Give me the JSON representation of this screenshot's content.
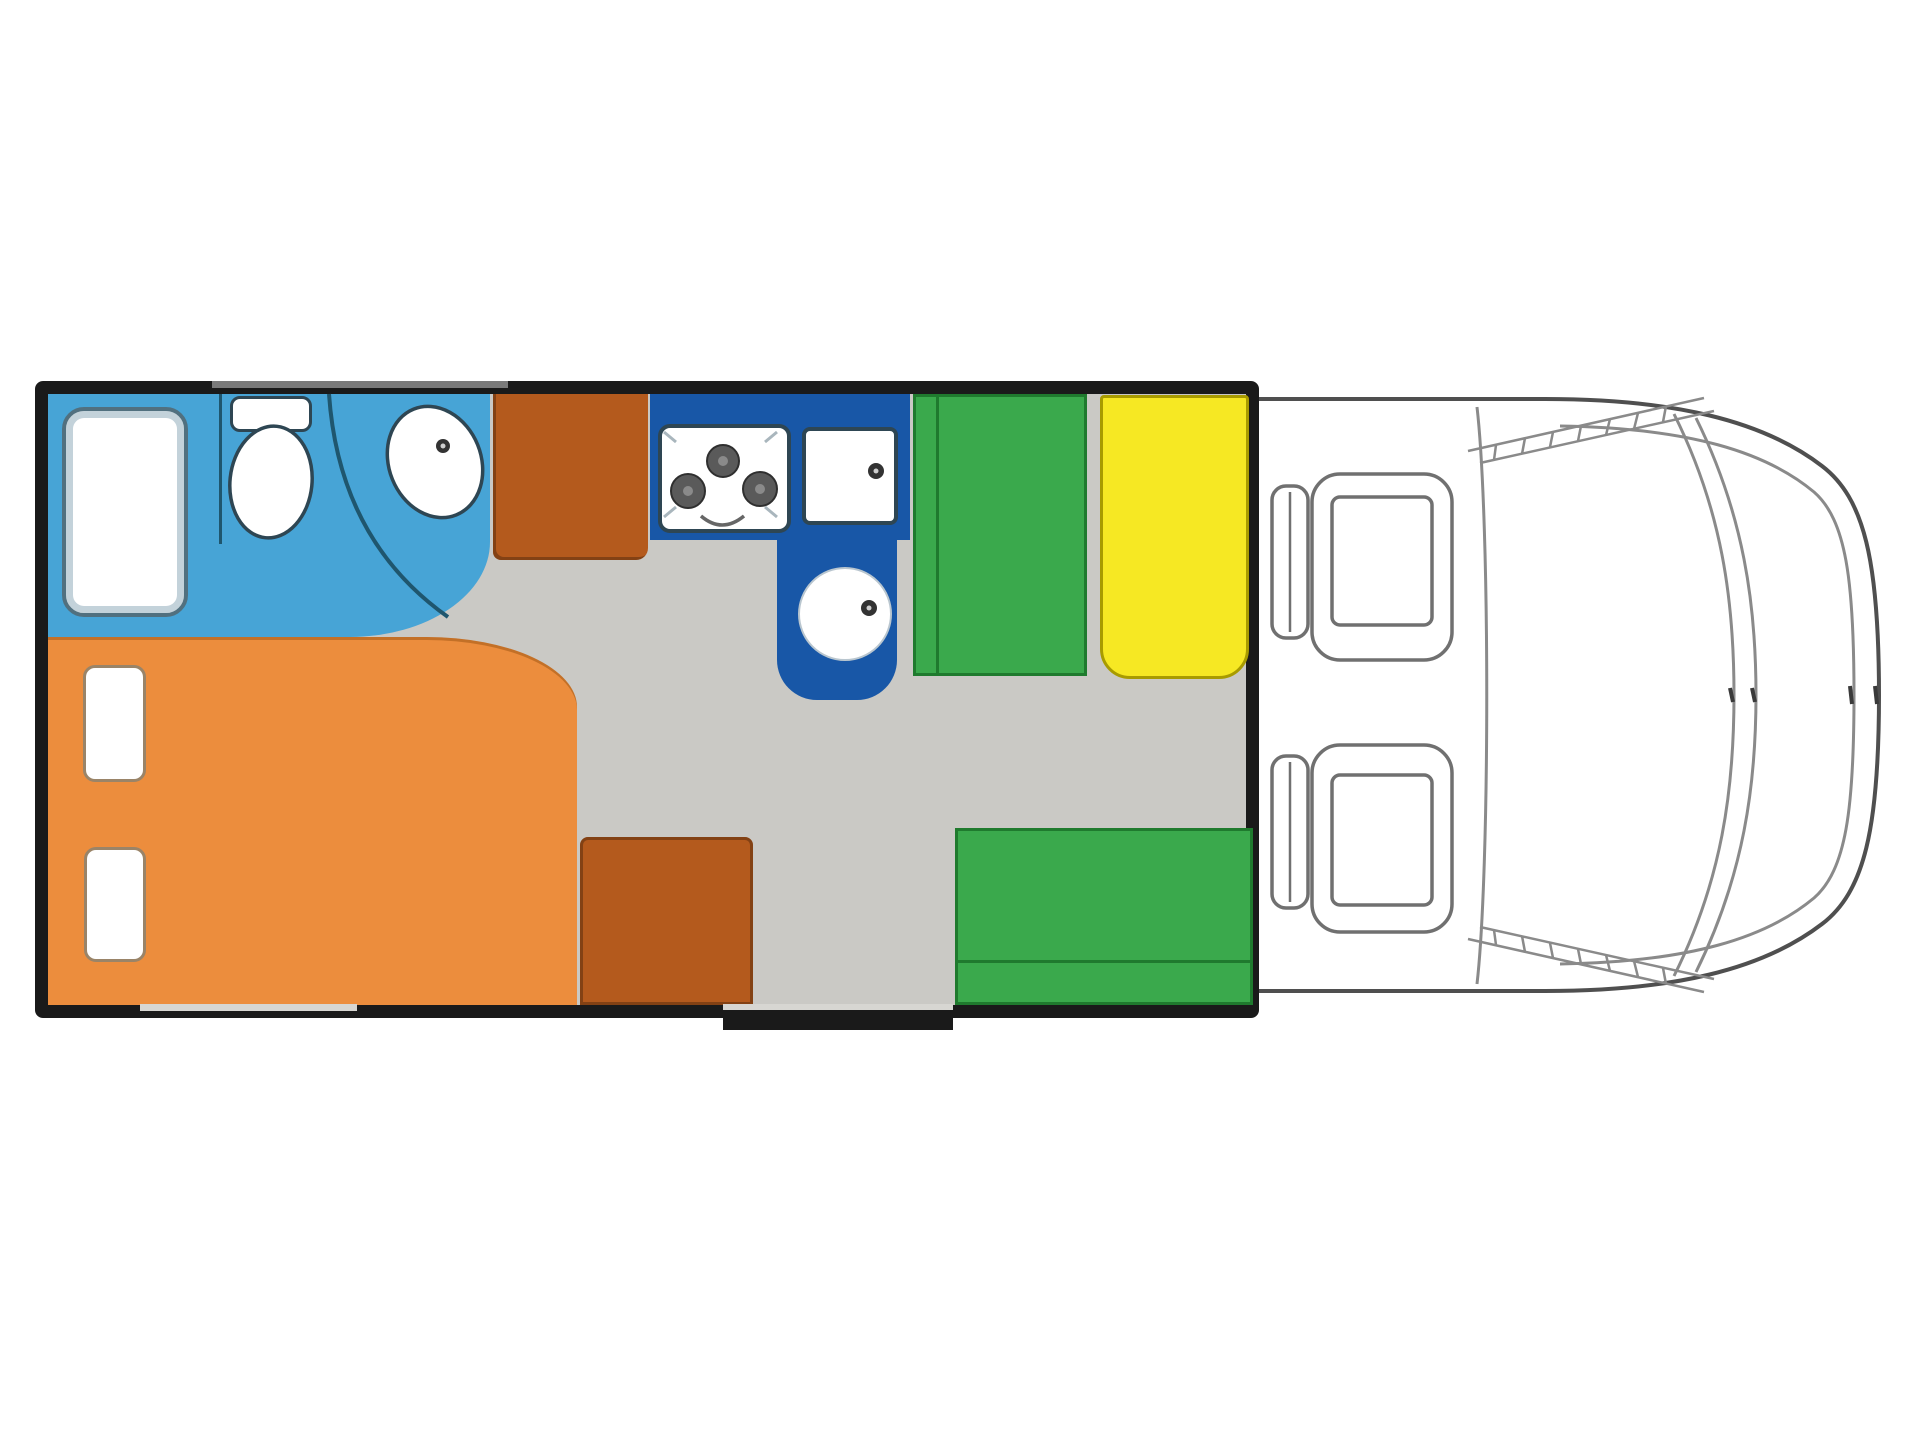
{
  "diagram": {
    "type": "motorhome-floorplan-top-view",
    "visible_text": [],
    "areas": {
      "bathroom": "shower, toilet and washbasin room (light blue)",
      "wardrobe": "tall cabinet beside bathroom (sienna)",
      "kitchen": "L-shaped kitchen block with hob, square sink and round sink (dark blue)",
      "dinette-front-bench": "forward bench seat (green)",
      "side-seat": "side bench (yellow)",
      "dinette-rear-bench": "rear bench seat (green)",
      "bed": "double bed with two pillows (orange)",
      "cabinet": "low cabinet at entry (sienna)",
      "cab": "driver cab with two swivel seats (outline drawing)"
    }
  },
  "colors": {
    "wall": "#1a1a1a",
    "floor": "#cac9c5",
    "bathroom": "#47a4d6",
    "kitchen": "#1857a7",
    "bed": "#ec8d3d",
    "cabinet": "#b45a1d",
    "bench-green": "#3aa94c",
    "bench-green-line": "#1f7a2e",
    "seat-yellow": "#f6e823",
    "seat-yellow-border": "#a89b00",
    "fixture-outline": "#2e4653",
    "fixture-line": "#1f566e",
    "shower-border": "#51707f",
    "shower-band": "#c3d2da",
    "pillow-border": "#9a8468",
    "cab-line": "#8a8a8a",
    "cab-outline": "#4f4f4f",
    "burner": "#5a5a5a",
    "window-gray": "#7a7a7a",
    "door-gray": "#d7d6d2",
    "white": "#ffffff"
  }
}
